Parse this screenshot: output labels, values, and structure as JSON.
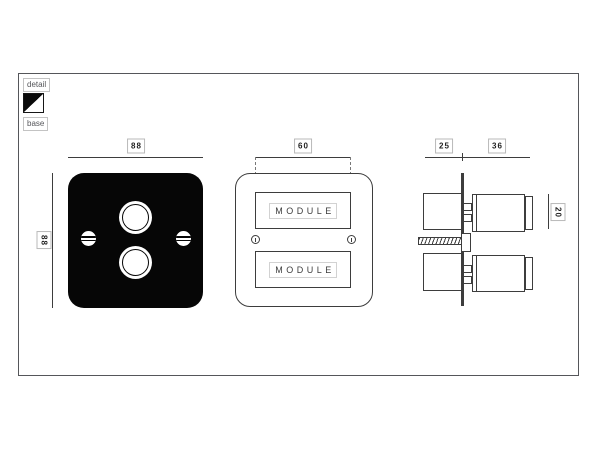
{
  "legend": {
    "detail": "detail",
    "base": "base"
  },
  "dimensions": {
    "plate_width": "88",
    "plate_height": "88",
    "module_width": "60",
    "depth_back": "25",
    "depth_front": "36",
    "knob_height": "20"
  },
  "modules": {
    "top": "MODULE",
    "bottom": "MODULE"
  },
  "colors": {
    "line": "#3d3d3d",
    "plate": "#060606",
    "frame": "#55565a",
    "label-border": "#b9b9b9",
    "label-text": "#1f1f1f",
    "legend-text": "#55565a",
    "detail-swatch": "#0a0a0a",
    "base-swatch": "#ffffff"
  }
}
